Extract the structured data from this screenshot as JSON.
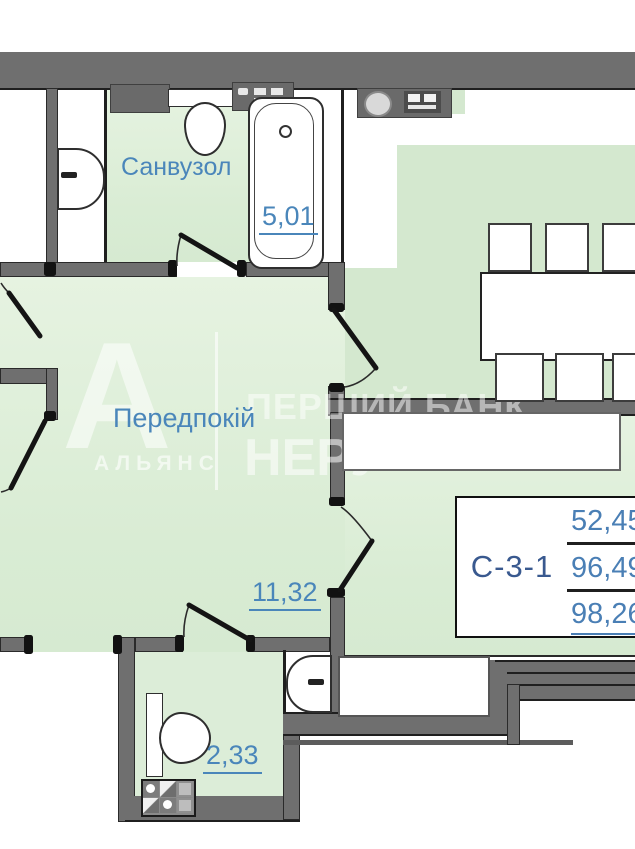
{
  "plan": {
    "rooms": [
      {
        "name": "Санвузол",
        "area": "5,01"
      },
      {
        "name": "Передпокій",
        "area": "11,32"
      },
      {
        "area": "2,33"
      }
    ],
    "unit_table": {
      "unit": "С-3-1",
      "rows": [
        "52,45",
        "96,49",
        "98,26"
      ]
    },
    "watermark": {
      "letter": "А",
      "brand": "АЛЬЯНС",
      "line1": "ПЕРШИЙ БАНК",
      "line2": "НЕРУ"
    },
    "colors": {
      "wall": "#6f6f6f",
      "floor_green": "#dcedd8",
      "label_blue": "#4a86ba",
      "unit_blue": "#39598f",
      "background": "#ffffff"
    }
  }
}
